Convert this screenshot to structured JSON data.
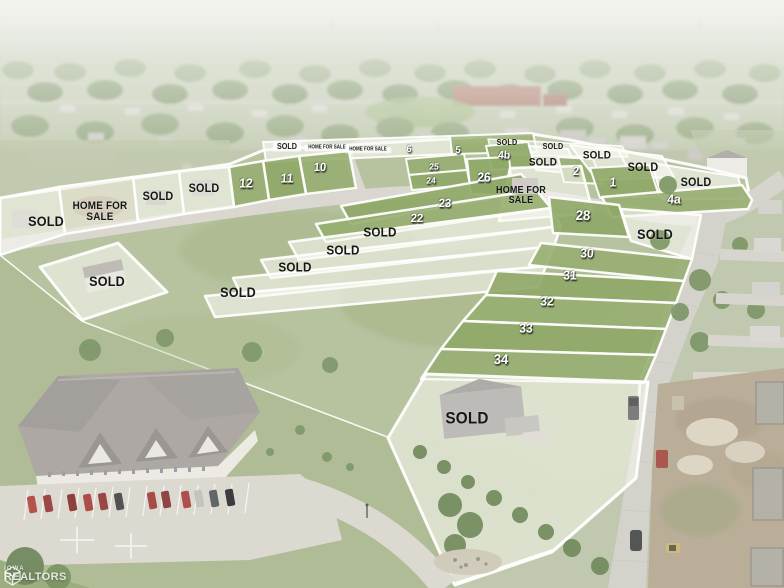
{
  "watermark": {
    "brand_top": "IOWA",
    "brand_bottom": "REALTORS"
  },
  "colors": {
    "lot_boundary_line": "#ffffff",
    "sold_lot_overlay": "rgba(248,249,243,0.62)",
    "available_lot_green": "#7f9c53",
    "dark_label_text": "#161616",
    "lot_number_text": "#ffffff"
  },
  "labels": [
    {
      "t": "SOLD",
      "x": 287,
      "y": 147,
      "s": 8,
      "st": "chip"
    },
    {
      "t": "HOME FOR SALE",
      "x": 327,
      "y": 148,
      "s": 5,
      "st": "chip"
    },
    {
      "t": "HOME FOR SALE",
      "x": 368,
      "y": 150,
      "s": 5,
      "st": "chip"
    },
    {
      "t": "6",
      "x": 409,
      "y": 150,
      "s": 10,
      "st": "number"
    },
    {
      "t": "5",
      "x": 458,
      "y": 151,
      "s": 10,
      "st": "number"
    },
    {
      "t": "SOLD",
      "x": 507,
      "y": 143,
      "s": 8,
      "st": "dark"
    },
    {
      "t": "SOLD",
      "x": 553,
      "y": 147,
      "s": 8,
      "st": "dark"
    },
    {
      "t": "4b",
      "x": 504,
      "y": 156,
      "s": 11,
      "st": "number"
    },
    {
      "t": "SOLD",
      "x": 543,
      "y": 163,
      "s": 11,
      "st": "dark"
    },
    {
      "t": "SOLD",
      "x": 597,
      "y": 156,
      "s": 11,
      "st": "dark"
    },
    {
      "t": "2",
      "x": 576,
      "y": 171,
      "s": 12,
      "st": "number"
    },
    {
      "t": "SOLD",
      "x": 643,
      "y": 167,
      "s": 12,
      "st": "dark"
    },
    {
      "t": "1",
      "x": 613,
      "y": 182,
      "s": 13,
      "st": "number"
    },
    {
      "t": "SOLD",
      "x": 696,
      "y": 182,
      "s": 12,
      "st": "dark"
    },
    {
      "t": "4a",
      "x": 674,
      "y": 199,
      "s": 13,
      "st": "number"
    },
    {
      "t": "10",
      "x": 320,
      "y": 167,
      "s": 12,
      "st": "number"
    },
    {
      "t": "11",
      "x": 287,
      "y": 178,
      "s": 13,
      "st": "number"
    },
    {
      "t": "12",
      "x": 246,
      "y": 183,
      "s": 13,
      "st": "number"
    },
    {
      "t": "25",
      "x": 434,
      "y": 167,
      "s": 9,
      "st": "number"
    },
    {
      "t": "24",
      "x": 431,
      "y": 181,
      "s": 9,
      "st": "number"
    },
    {
      "t": "26",
      "x": 484,
      "y": 177,
      "s": 13,
      "st": "number"
    },
    {
      "lines": [
        "HOME FOR",
        "SALE"
      ],
      "x": 521,
      "y": 196,
      "s": 10,
      "st": "dark"
    },
    {
      "t": "SOLD",
      "x": 204,
      "y": 188,
      "s": 12,
      "st": "dark"
    },
    {
      "t": "SOLD",
      "x": 158,
      "y": 196,
      "s": 12,
      "st": "dark"
    },
    {
      "lines": [
        "HOME FOR",
        "SALE"
      ],
      "x": 100,
      "y": 212,
      "s": 11,
      "st": "dark"
    },
    {
      "t": "SOLD",
      "x": 46,
      "y": 221,
      "s": 14,
      "st": "dark"
    },
    {
      "t": "23",
      "x": 445,
      "y": 203,
      "s": 12,
      "st": "number"
    },
    {
      "t": "22",
      "x": 417,
      "y": 218,
      "s": 12,
      "st": "number"
    },
    {
      "t": "SOLD",
      "x": 380,
      "y": 232,
      "s": 13,
      "st": "dark"
    },
    {
      "t": "SOLD",
      "x": 343,
      "y": 250,
      "s": 13,
      "st": "dark"
    },
    {
      "t": "SOLD",
      "x": 295,
      "y": 267,
      "s": 13,
      "st": "dark"
    },
    {
      "t": "SOLD",
      "x": 238,
      "y": 292,
      "s": 14,
      "st": "dark"
    },
    {
      "t": "SOLD",
      "x": 107,
      "y": 281,
      "s": 14,
      "st": "dark"
    },
    {
      "t": "28",
      "x": 583,
      "y": 215,
      "s": 14,
      "st": "number"
    },
    {
      "t": "SOLD",
      "x": 655,
      "y": 234,
      "s": 14,
      "st": "dark"
    },
    {
      "t": "30",
      "x": 587,
      "y": 253,
      "s": 13,
      "st": "number"
    },
    {
      "t": "31",
      "x": 570,
      "y": 275,
      "s": 13,
      "st": "number"
    },
    {
      "t": "32",
      "x": 547,
      "y": 301,
      "s": 13,
      "st": "number"
    },
    {
      "t": "33",
      "x": 526,
      "y": 328,
      "s": 13,
      "st": "number"
    },
    {
      "t": "34",
      "x": 501,
      "y": 359,
      "s": 14,
      "st": "number"
    },
    {
      "t": "SOLD",
      "x": 467,
      "y": 418,
      "s": 17,
      "st": "dark"
    }
  ]
}
